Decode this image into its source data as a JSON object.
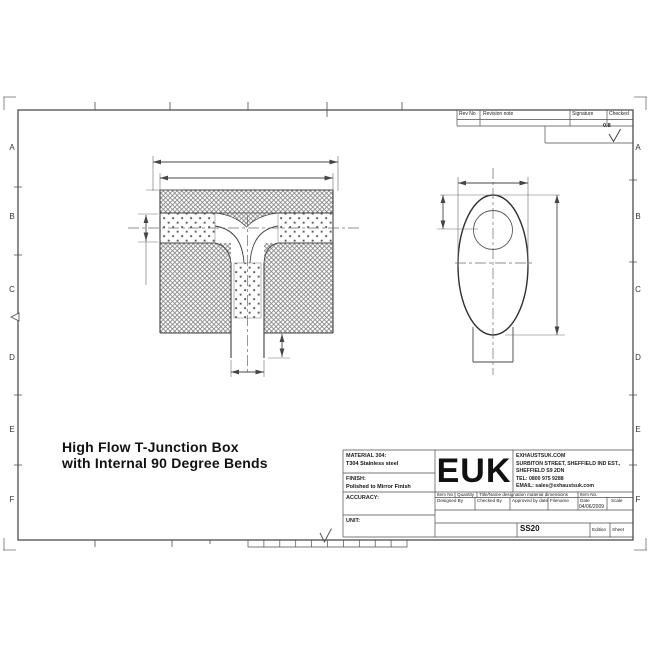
{
  "sheet": {
    "title_line1": "High Flow T-Junction Box",
    "title_line2": "with Internal 90 Degree Bends",
    "border_zones": [
      "A",
      "B",
      "C",
      "D",
      "E",
      "F"
    ]
  },
  "revision_table": {
    "headers": [
      "Rev No",
      "Revision note",
      "Signature",
      "Checked"
    ],
    "surface_finish": "0.8"
  },
  "title_block": {
    "material_label": "MATERIAL 304:",
    "material_value": "T304 Stainless steel",
    "finish_label": "FINISH:",
    "finish_value": "Polished to Mirror Finish",
    "accuracy_label": "ACCURACY:",
    "unit_label": "UNIT:",
    "logo": "EUK",
    "company": {
      "website": "EXHAUSTSUK.COM",
      "address1": "SURBITON STREET, SHEFFIELD IND EST.,",
      "address2": "SHEFFIELD S9 2DN",
      "tel": "TEL: 0800 975 9288",
      "email": "EMAIL: sales@exhaustsuk.com"
    },
    "row1_headers": [
      "Item No",
      "Quantity",
      "Title/Name designation material dimensions",
      "Item No."
    ],
    "row2_headers": [
      "Designed By",
      "Checked By",
      "Approved by date",
      "Filename",
      "Date",
      "Scale"
    ],
    "date_value": "04/06/2009",
    "drawing_number": "SS20",
    "edition_label": "Edition",
    "sheet_label": "Sheet"
  },
  "colors": {
    "line": "#4d4d4d",
    "text": "#1c1c1c",
    "paper": "#ffffff"
  }
}
